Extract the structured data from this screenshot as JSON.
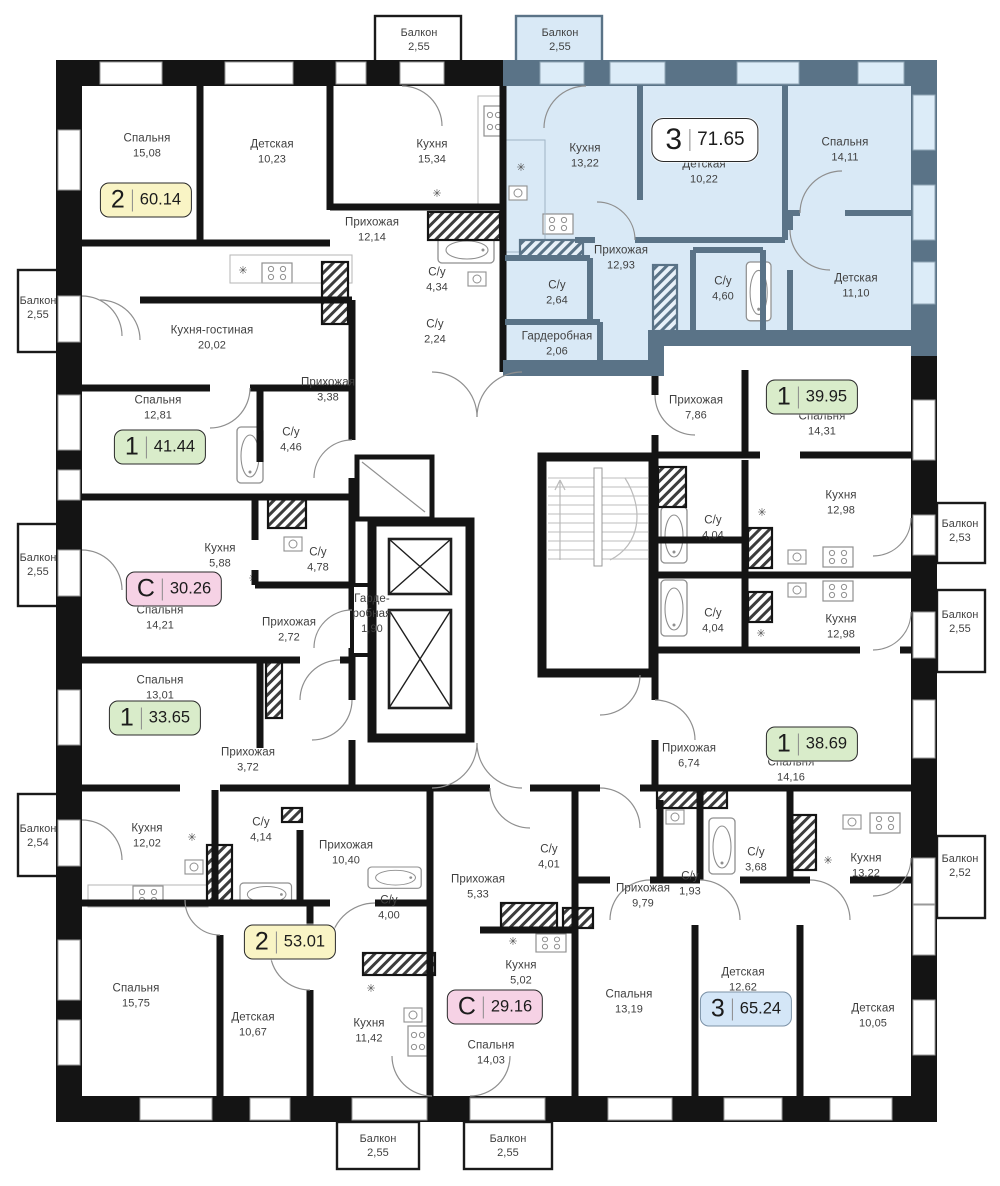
{
  "highlight": {
    "fill": "#d9e9f6",
    "wall": "#5a7387",
    "window": "#dcecf8"
  },
  "wall_color": "#141414",
  "apartments": [
    {
      "type": "2",
      "total_area": "60.14",
      "badge_color": "#f9f4c5",
      "rooms": [
        {
          "name": "Спальня",
          "area": "15,08"
        },
        {
          "name": "Детская",
          "area": "10,23"
        },
        {
          "name": "Кухня",
          "area": "15,34"
        },
        {
          "name": "Прихожая",
          "area": "12,14"
        },
        {
          "name": "С/у",
          "area": "4,34"
        },
        {
          "name": "С/у",
          "area": "2,24"
        }
      ]
    },
    {
      "type": "1",
      "total_area": "41.44",
      "badge_color": "#d9ecca",
      "rooms": [
        {
          "name": "Кухня-гостиная",
          "area": "20,02"
        },
        {
          "name": "Спальня",
          "area": "12,81"
        },
        {
          "name": "С/у",
          "area": "4,46"
        },
        {
          "name": "Прихожая",
          "area": "3,38"
        }
      ]
    },
    {
      "type": "С",
      "total_area": "30.26",
      "badge_color": "#f6d2e5",
      "rooms": [
        {
          "name": "Кухня",
          "area": "5,88"
        },
        {
          "name": "С/у",
          "area": "4,78"
        },
        {
          "name": "Спальня",
          "area": "14,21"
        },
        {
          "name": "Прихожая",
          "area": "2,72"
        },
        {
          "name": "Гарде-\nробная",
          "area": "1,90"
        }
      ]
    },
    {
      "type": "1",
      "total_area": "33.65",
      "badge_color": "#d9ecca",
      "rooms": [
        {
          "name": "Спальня",
          "area": "13,01"
        },
        {
          "name": "Прихожая",
          "area": "3,72"
        }
      ]
    },
    {
      "type": "2",
      "total_area": "53.01",
      "badge_color": "#f9f4c5",
      "rooms": [
        {
          "name": "Кухня",
          "area": "12,02"
        },
        {
          "name": "С/у",
          "area": "4,14"
        },
        {
          "name": "Прихожая",
          "area": "10,40"
        },
        {
          "name": "С/у",
          "area": "4,00"
        },
        {
          "name": "Спальня",
          "area": "15,75"
        },
        {
          "name": "Детская",
          "area": "10,67"
        },
        {
          "name": "Кухня",
          "area": "11,42"
        }
      ]
    },
    {
      "type": "С",
      "total_area": "29.16",
      "badge_color": "#f6d2e5",
      "rooms": [
        {
          "name": "Прихожая",
          "area": "5,33"
        },
        {
          "name": "С/у",
          "area": "4,01"
        },
        {
          "name": "Кухня",
          "area": "5,02"
        },
        {
          "name": "Спальня",
          "area": "14,03"
        }
      ]
    },
    {
      "type": "3",
      "total_area": "65.24",
      "badge_color": "#d4e6f7",
      "rooms": [
        {
          "name": "Прихожая",
          "area": "9,79"
        },
        {
          "name": "С/у",
          "area": "1,93"
        },
        {
          "name": "С/у",
          "area": "3,68"
        },
        {
          "name": "Кухня",
          "area": "13,22"
        },
        {
          "name": "Спальня",
          "area": "13,19"
        },
        {
          "name": "Детская",
          "area": "12,62"
        },
        {
          "name": "Детская",
          "area": "10,05"
        }
      ]
    },
    {
      "type": "1",
      "total_area": "39.95",
      "badge_color": "#d9ecca",
      "rooms": [
        {
          "name": "Прихожая",
          "area": "7,86"
        },
        {
          "name": "Спальня",
          "area": "14,31"
        },
        {
          "name": "Кухня",
          "area": "12,98"
        },
        {
          "name": "С/у",
          "area": "4,04"
        }
      ]
    },
    {
      "type": "1",
      "total_area": "38.69",
      "badge_color": "#d9ecca",
      "rooms": [
        {
          "name": "С/у",
          "area": "4,04"
        },
        {
          "name": "Кухня",
          "area": "12,98"
        },
        {
          "name": "Прихожая",
          "area": "6,74"
        },
        {
          "name": "Спальня",
          "area": "14,16"
        }
      ]
    },
    {
      "type": "3",
      "total_area": "71.65",
      "badge_color": "#ffffff",
      "highlighted": true,
      "rooms": [
        {
          "name": "Балкон",
          "area": "2,55"
        },
        {
          "name": "Кухня",
          "area": "13,22"
        },
        {
          "name": "Детская",
          "area": "10,22"
        },
        {
          "name": "Спальня",
          "area": "14,11"
        },
        {
          "name": "Прихожая",
          "area": "12,93"
        },
        {
          "name": "С/у",
          "area": "2,64"
        },
        {
          "name": "С/у",
          "area": "4,60"
        },
        {
          "name": "Детская",
          "area": "11,10"
        },
        {
          "name": "Гардеробная",
          "area": "2,06"
        }
      ]
    }
  ],
  "balconies": [
    {
      "name": "Балкон",
      "area": "2,55"
    },
    {
      "name": "Балкон",
      "area": "2,55"
    },
    {
      "name": "Балкон",
      "area": "2,55"
    },
    {
      "name": "Балкон",
      "area": "2,54"
    },
    {
      "name": "Балкон",
      "area": "2,53"
    },
    {
      "name": "Балкон",
      "area": "2,55"
    },
    {
      "name": "Балкон",
      "area": "2,52"
    },
    {
      "name": "Балкон",
      "area": "2,55"
    },
    {
      "name": "Балкон",
      "area": "2,55"
    }
  ]
}
